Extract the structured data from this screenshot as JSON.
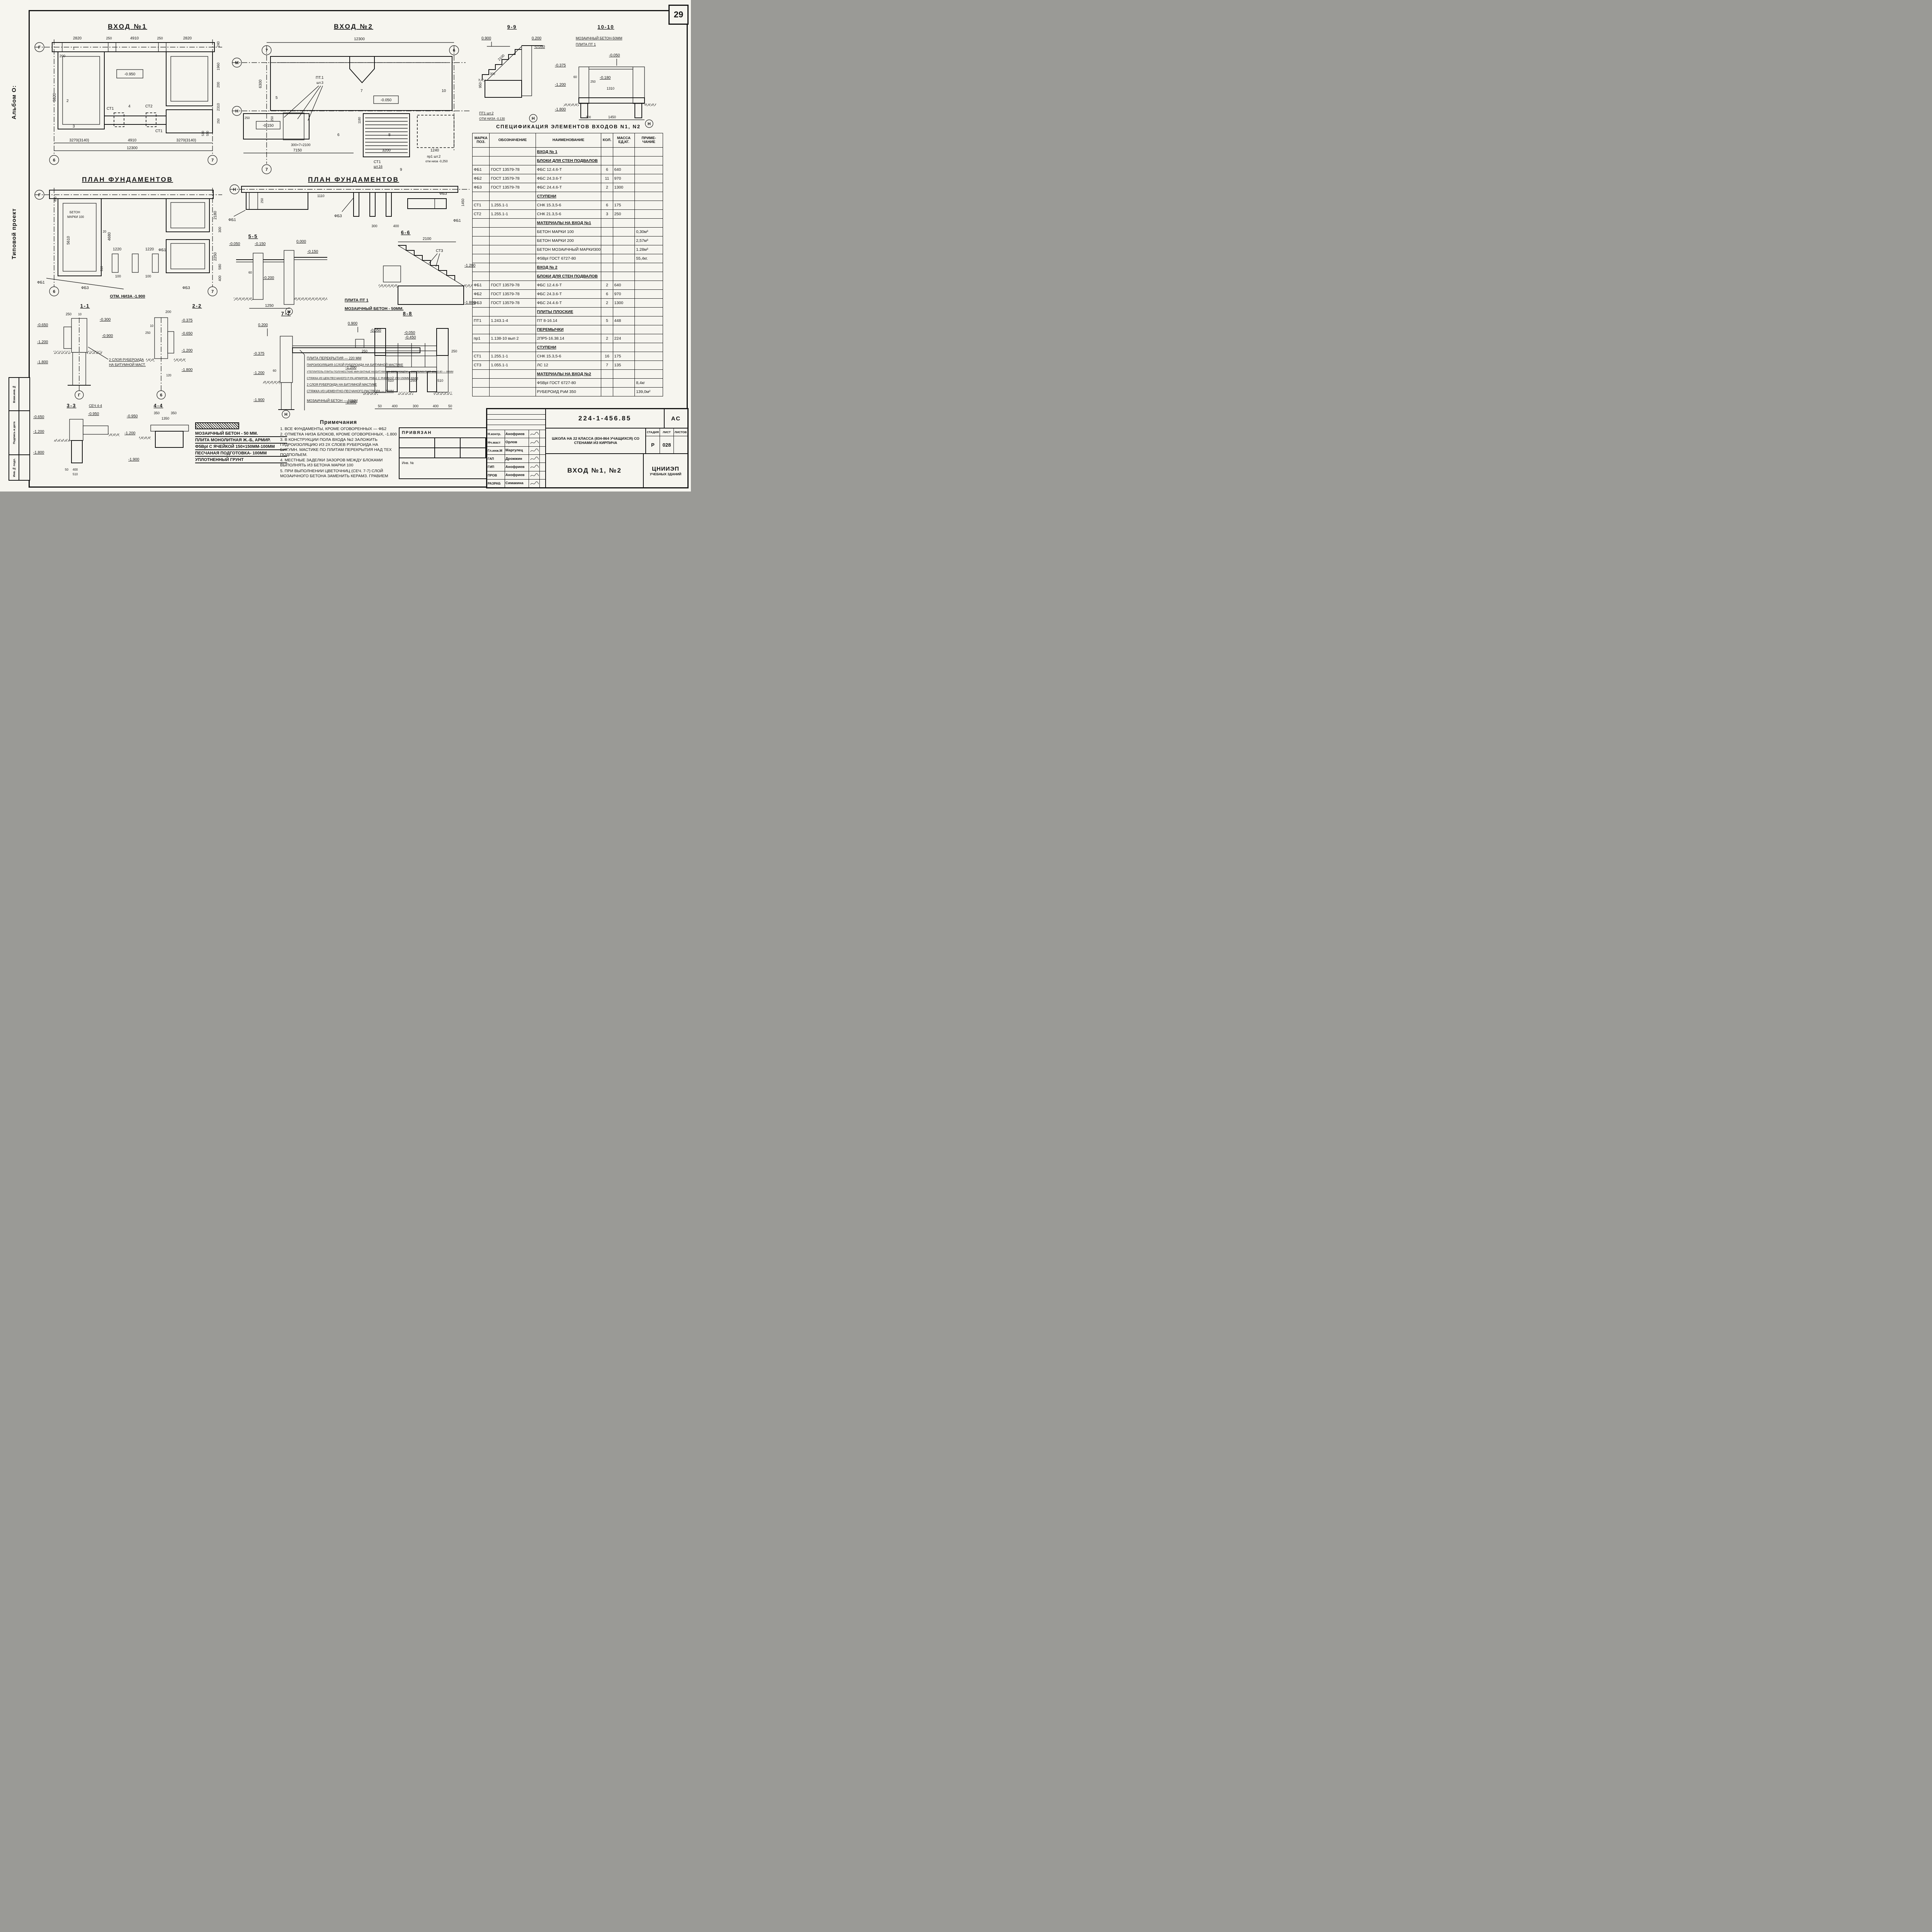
{
  "sheet": {
    "page_number": "29",
    "album_label": "Альбом О:",
    "project_type_label": "Типовой проект",
    "side_stamp": {
      "c1": "Взам.инв.№",
      "c2": "Подпись и дата",
      "c3": "Инв.№ подл."
    }
  },
  "p1": {
    "title": "ВХОД №1",
    "axis_g": "Г",
    "axis_6": "6",
    "axis_7": "7",
    "lvl": "-0.950",
    "st1": "СТ1",
    "st2": "СТ2",
    "st1b": "СТ1",
    "m1": "1",
    "m2": "2",
    "m3": "3",
    "m4": "4",
    "dt": [
      "2820",
      "250",
      "4910",
      "250",
      "2820"
    ],
    "dr": [
      "240",
      "1960",
      "200",
      "2310",
      "250",
      "550",
      "510"
    ],
    "dl": [
      "200",
      "5320"
    ],
    "db": [
      "3270(3140)",
      "4910",
      "3270(3140)",
      "12300"
    ]
  },
  "f1": {
    "title": "ПЛАН ФУНДАМЕНТОВ",
    "axis_g": "Г",
    "axis_6": "6",
    "axis_7": "7",
    "t1": "БЕТОН",
    "t2": "МАРКИ 100",
    "fb1": "ФБ1",
    "fb3": "ФБ3",
    "fb1b": "ФБ1",
    "fb3b": "ФБ3",
    "bot": "ОТМ. НИЗА -1.900",
    "d": [
      "490",
      "5610",
      "4680",
      "1220",
      "100",
      "1220",
      "100",
      "2180",
      "300",
      "2250",
      "580",
      "400",
      "20",
      "510"
    ]
  },
  "p2": {
    "title": "ВХОД №2",
    "top": "12300",
    "axis_m": "М",
    "axis_n": "Н",
    "axis_7": "7",
    "axis_6": "6",
    "lvl1": "-0.050",
    "lvl2": "-0.150",
    "pt": "ПТ.1",
    "ptq": "шт.3",
    "st": "СТ1",
    "stq": "шт.16",
    "pr": "пр1 шт.2",
    "prn": "отм низа -0,250",
    "d": [
      "6300",
      "250",
      "1180",
      "300×7=2100",
      "7150",
      "3200",
      "1240",
      "250"
    ],
    "mk": [
      "5",
      "6",
      "7",
      "8",
      "9",
      "10"
    ]
  },
  "f2": {
    "title": "ПЛАН ФУНДАМЕНТОВ",
    "axis_n": "Н",
    "fb1": "ФБ1",
    "fb3": "ФБ3",
    "fb3b": "ФБ3",
    "fb1b": "ФБ1",
    "d": [
      "250",
      "1110",
      "1450",
      "300",
      "400"
    ]
  },
  "s55": {
    "title": "5-5",
    "l": [
      "-0.050",
      "-0.150",
      "0.000",
      "-0.150",
      "-0.200"
    ],
    "d": [
      "60",
      "1250"
    ],
    "axis": "Н"
  },
  "s66": {
    "title": "6-6",
    "d": "2100",
    "mark": "СТ3",
    "l1": "-1.200",
    "l2": "-1.800",
    "cap1": "ПЛИТА ПТ 1",
    "cap2": "МОЗАИЧНЫЙ БЕТОН - 50ММ."
  },
  "s11": {
    "title": "1-1",
    "l": [
      "-0.650",
      "-1.200",
      "-1.800",
      "-0.300",
      "-0.900"
    ],
    "d": [
      "250",
      "10"
    ],
    "note1": "2 СЛОЯ РУБЕРОИДА",
    "note2": "НА БИТУМНОЙ МАСТ.",
    "axis": "Г"
  },
  "s22": {
    "title": "2-2",
    "l": [
      "-0.375",
      "-0.650",
      "-1.200",
      "-1.800"
    ],
    "d": [
      "200",
      "250",
      "10",
      "120"
    ],
    "axis": "6"
  },
  "s33": {
    "title": "3-3",
    "title2": "СЕЧ 4-4",
    "l": [
      "-0.650",
      "-1.200",
      "-0.950",
      "-1.800"
    ],
    "d": [
      "50",
      "400",
      "510"
    ]
  },
  "s44": {
    "title": "4-4",
    "l": [
      "-0.950",
      "-1.200",
      "-1.900"
    ],
    "d": [
      "350",
      "350",
      "1350"
    ]
  },
  "s77": {
    "title": "7-7",
    "l": [
      "0.200",
      "-0.050",
      "-0.450",
      "-0.375",
      "-1.200",
      "-1.900"
    ],
    "d60": "60",
    "axis": "Н",
    "layers": [
      "ПЛИТА ПЕРЕКРЫТИЯ — 220 ММ",
      "ПАРОИЗОЛЯЦИЯ-1СЛОЙ РУБЕРОИДА НА БИТУМНОЙ МАСТИКЕ",
      "УТЕПЛИТЕЛЬ-ПЛИТЫ ПОЛУЖЕСТКИЕ МИН.ВАТНЫЕ НА БИТУМНОМ СВЯЗУЮЩЕМ γ=200КГС/М3 ГОСТ 10140-80 — 80ММ",
      "СТЯЖКА ИЗ ЦЕМ.ПЕСЧАНОГО Р-РА АРМИРОВ. Р5Вэ1 С ЯЧЕЙКОЙ 150×150ММ-30ММ",
      "2 СЛОЯ РУБЕРОИДА НА БИТУМНОЙ МАСТИКЕ",
      "СТЯЖКА ИЗ ЦЕМЕНТНО-ПЕСЧАНОГО РАСТВОРА — 20ММ",
      "МОЗАИЧНЫЙ БЕТОН — 50ММ"
    ]
  },
  "s88": {
    "title": "8-8",
    "l": [
      "0.900",
      "-0.050",
      "-1.200",
      "-1.900"
    ],
    "d": [
      "250",
      "250",
      "510",
      "250",
      "510",
      "50",
      "400",
      "300",
      "400",
      "50"
    ]
  },
  "s99": {
    "title": "9-9",
    "l": [
      "0.900",
      "0.200",
      "-0.050"
    ],
    "d": [
      "2100",
      "300",
      "950"
    ],
    "cap1": "ПТ1 шт.2",
    "cap2": "ОТМ НИЗА -0,130",
    "axis": "Н"
  },
  "s1010": {
    "title": "10-10",
    "cap1": "МОЗАИЧНЫЙ БЕТОН-50ММ",
    "cap2": "ПЛИТА ПТ 1",
    "l": [
      "-0.050",
      "-0.180",
      "-0.375",
      "-1.200",
      "-1.800"
    ],
    "d": [
      "60",
      "250",
      "1310",
      "300",
      "1450"
    ],
    "axis": "Н"
  },
  "legend": {
    "rows": [
      "МОЗАИЧНЫЙ БЕТОН - 50 ММ.",
      "ПЛИТА МОНОЛИТНАЯ Ж.-Б, АРМИР.",
      "Ф5ВрI С ЯЧЕЙКОЙ 150×150ММ-100ММ",
      "ПЕСЧАНАЯ ПОДГОТОВКА- 100ММ",
      "УПЛОТНЕННЫЙ ГРУНТ"
    ]
  },
  "notes": {
    "title": "Примечания",
    "items": [
      "1. ВСЕ ФУНДАМЕНТЫ, КРОМЕ ОГОВОРЕННЫХ — ФБ2",
      "2. ОТМЕТКА НИЗА БЛОКОВ, КРОМЕ ОГОВОРЕННЫХ, -1.800",
      "3. В КОНСТРУКЦИИ ПОЛА ВХОДА №2 ЗАЛОЖИТЬ ГИДРОИЗОЛЯЦИЮ ИЗ 2Х СЛОЕВ РУБЕРОИДА НА БИТУМН. МАСТИКЕ ПО ПЛИТАМ ПЕРЕКРЫТИЯ НАД ТЕХ ПОДПОЛЬЕМ.",
      "4. МЕСТНЫЕ ЗАДЕЛКИ ЗАЗОРОВ МЕЖДУ БЛОКАМИ ВЫПОЛНЯТЬ ИЗ БЕТОНА МАРКИ 100",
      "5. ПРИ ВЫПОЛНЕНИИ ЦВЕТОЧНИЦ (СЕЧ. 7-7) СЛОЙ МОЗАИЧНОГО БЕТОНА ЗАМЕНИТЬ КЕРАМЗ. ГРАВИЕМ"
    ]
  },
  "spec": {
    "title": "СПЕЦИФИКАЦИЯ ЭЛЕМЕНТОВ ВХОДОВ N1, N2",
    "h": {
      "pos": "МАРКА ПОЗ.",
      "ref": "ОБОЗНАЧЕНИЕ",
      "name": "НАИМЕНОВАНИЕ",
      "qty": "КОЛ.",
      "mass": "МАССА ЕД,КГ.",
      "note": "ПРИМЕ- ЧАНИЕ"
    },
    "rows": [
      {
        "pos": "",
        "ref": "",
        "name": "ВХОД № 1",
        "qty": "",
        "mass": "",
        "note": ""
      },
      {
        "pos": "",
        "ref": "",
        "name": "БЛОКИ ДЛЯ СТЕН ПОДВАЛОВ",
        "qty": "",
        "mass": "",
        "note": ""
      },
      {
        "pos": "ФБ1",
        "ref": "ГОСТ 13579-78",
        "name": "ФБС 12.4.6-Т",
        "qty": "6",
        "mass": "640",
        "note": ""
      },
      {
        "pos": "ФБ2",
        "ref": "ГОСТ 13579-78",
        "name": "ФБС 24.3.6-Т",
        "qty": "11",
        "mass": "970",
        "note": ""
      },
      {
        "pos": "ФБ3",
        "ref": "ГОСТ 13579-78",
        "name": "ФБС 24.4.6-Т",
        "qty": "2",
        "mass": "1300",
        "note": ""
      },
      {
        "pos": "",
        "ref": "",
        "name": "СТУПЕНИ",
        "qty": "",
        "mass": "",
        "note": ""
      },
      {
        "pos": "СТ1",
        "ref": "1.255.1-1",
        "name": "СНК 15.3,5-6",
        "qty": "6",
        "mass": "175",
        "note": ""
      },
      {
        "pos": "СТ2",
        "ref": "1.255.1-1",
        "name": "СНК 21.3,5-6",
        "qty": "3",
        "mass": "250",
        "note": ""
      },
      {
        "pos": "",
        "ref": "",
        "name": "МАТЕРИАЛЫ НА ВХОД №1",
        "qty": "",
        "mass": "",
        "note": ""
      },
      {
        "pos": "",
        "ref": "",
        "name": "БЕТОН МАРКИ 100",
        "qty": "",
        "mass": "",
        "note": "0,30м³"
      },
      {
        "pos": "",
        "ref": "",
        "name": "БЕТОН МАРКИ 200",
        "qty": "",
        "mass": "",
        "note": "2,57м³"
      },
      {
        "pos": "",
        "ref": "",
        "name": "БЕТОН МОЗАИЧНЫЙ МАРКИ300",
        "qty": "",
        "mass": "",
        "note": "1.28м³"
      },
      {
        "pos": "",
        "ref": "",
        "name": "Ф5ВрI ГОСТ 6727-80",
        "qty": "",
        "mass": "",
        "note": "55,4кг."
      },
      {
        "pos": "",
        "ref": "",
        "name": "ВХОД № 2",
        "qty": "",
        "mass": "",
        "note": ""
      },
      {
        "pos": "",
        "ref": "",
        "name": "БЛОКИ ДЛЯ СТЕН ПОДВАЛОВ",
        "qty": "",
        "mass": "",
        "note": ""
      },
      {
        "pos": "ФБ1",
        "ref": "ГОСТ 13579-78",
        "name": "ФБС 12.4.6-Т",
        "qty": "2",
        "mass": "640",
        "note": ""
      },
      {
        "pos": "ФБ2",
        "ref": "ГОСТ 13579-78",
        "name": "ФБС 24.3.6-Т",
        "qty": "6",
        "mass": "970",
        "note": ""
      },
      {
        "pos": "ФБ3",
        "ref": "ГОСТ 13579-78",
        "name": "ФБС 24.4.6-Т",
        "qty": "2",
        "mass": "1300",
        "note": ""
      },
      {
        "pos": "",
        "ref": "",
        "name": "ПЛИТЫ ПЛОСКИЕ",
        "qty": "",
        "mass": "",
        "note": ""
      },
      {
        "pos": "ПТ1",
        "ref": "1.243.1-4",
        "name": "ПТ 8-16.14",
        "qty": "5",
        "mass": "448",
        "note": ""
      },
      {
        "pos": "",
        "ref": "",
        "name": "ПЕРЕМЫЧКИ",
        "qty": "",
        "mass": "",
        "note": ""
      },
      {
        "pos": "пр1",
        "ref": "1.138-10 вып 2",
        "name": "2ПР5-16.38.14",
        "qty": "2",
        "mass": "224",
        "note": ""
      },
      {
        "pos": "",
        "ref": "",
        "name": "СТУПЕНИ",
        "qty": "",
        "mass": "",
        "note": ""
      },
      {
        "pos": "СТ1",
        "ref": "1.255.1-1",
        "name": "СНК 15.3,5-6",
        "qty": "16",
        "mass": "175",
        "note": ""
      },
      {
        "pos": "СТ3",
        "ref": "1.055.1-1",
        "name": "ЛС 12",
        "qty": "7",
        "mass": "135",
        "note": ""
      },
      {
        "pos": "",
        "ref": "",
        "name": "МАТЕРИАЛЫ НА ВХОД №2",
        "qty": "",
        "mass": "",
        "note": ""
      },
      {
        "pos": "",
        "ref": "",
        "name": "Ф5ВрI ГОСТ 6727-80",
        "qty": "",
        "mass": "",
        "note": "8,4кг"
      },
      {
        "pos": "",
        "ref": "",
        "name": "РУБЕРОИД РэМ 350",
        "qty": "",
        "mass": "",
        "note": "139,0м²"
      }
    ]
  },
  "pv": {
    "title": "ПРИВЯЗАН",
    "inv": "Инв. №"
  },
  "tb": {
    "doc": "224-1-456.85",
    "code": "АС",
    "project": "ШКОЛА НА 22 КЛАССА (834-864 УЧАЩИХСЯ) СО СТЕНАМИ ИЗ КИРПИЧА",
    "stage_h": "СТАДИЯ",
    "list_h": "ЛИСТ",
    "lists_h": "ЛИСТОВ",
    "stage": "Р",
    "list": "028",
    "lists": "",
    "sheet_title": "ВХОД №1, №2",
    "org1": "ЦНИИЭП",
    "org2": "УЧЕБНЫХ ЗДАНИЙ",
    "sig": [
      {
        "r": "Н.контр.",
        "n": "Анофриев"
      },
      {
        "r": "Нч.маст",
        "n": "Орлов"
      },
      {
        "r": "Гл.инж.М",
        "n": "Маргулец"
      },
      {
        "r": "ГАП",
        "n": "Дрожжин"
      },
      {
        "r": "ГИП",
        "n": "Анофриев"
      },
      {
        "r": "ПРОВ",
        "n": "Анофриев"
      },
      {
        "r": "РАЗРАБ",
        "n": "Симакина"
      }
    ]
  }
}
